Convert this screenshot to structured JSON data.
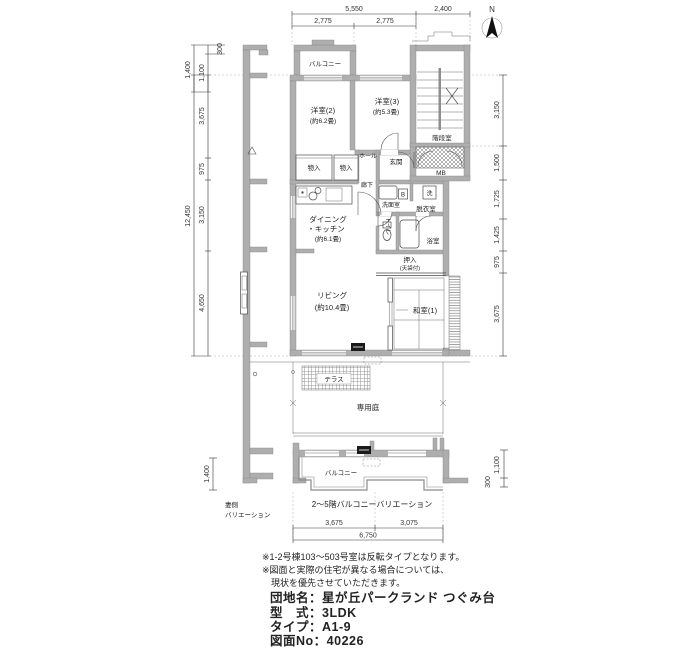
{
  "compass": {
    "north_label": "N"
  },
  "dims": {
    "top": {
      "total": "5,550",
      "left_half": "2,775",
      "right_half": "2,775",
      "stair": "2,400"
    },
    "left": {
      "w300": "300",
      "w1400": "1,400",
      "w1100": "1,100",
      "total": "12,450",
      "r1": "3,675",
      "r2": "975",
      "r3": "3,150",
      "r4": "4,650"
    },
    "right": {
      "r1": "3,150",
      "r2": "1,500",
      "r3": "1,725",
      "r4": "1,425",
      "r5": "975",
      "r6": "3,675"
    },
    "bottom": {
      "left": "3,675",
      "right": "3,075",
      "total": "6,750"
    },
    "bottom_left": {
      "h": "1,400"
    },
    "bottom_right": {
      "w1100": "1,100",
      "w300": "300"
    }
  },
  "rooms": {
    "balcony_top": "バルコニー",
    "bed2": "洋室(2)",
    "bed2_size": "(約6.2畳)",
    "bed3": "洋室(3)",
    "bed3_size": "(約5.3畳)",
    "stairwell": "階段室",
    "mb": "MB",
    "entrance": "玄関",
    "hall": "ホール",
    "closet1": "物入",
    "closet2": "物入",
    "corridor": "廊下",
    "washroom": "洗面室",
    "basin_tag": "B",
    "laundry_tag": "洗",
    "dressing": "脱衣室",
    "toilet": "トイレ",
    "bath": "浴室",
    "dk1": "ダイニング",
    "dk2": "・キッチン",
    "dk_size": "(約6.1畳)",
    "oshiire": "押入",
    "oshiire_note": "(天袋付)",
    "living": "リビング",
    "living_size": "(約10.4畳)",
    "washitsu": "和室(1)",
    "terrace": "テラス",
    "garden": "専用庭",
    "balcony_bottom": "バルコニー"
  },
  "captions": {
    "gable1": "妻側",
    "gable2": "バリエーション",
    "balcony_variation": "2〜5階バルコニーバリエーション"
  },
  "notes": [
    "※1-2号棟103〜503号室は反転タイプとなります。",
    "※図面と実際の住宅が異なる場合については、",
    "現状を優先させていただきます。"
  ],
  "info": {
    "lines": [
      "団地名：星が丘パークランド つぐみ台",
      "型　式：3LDK",
      "タイプ：A1-9",
      "図面No：40226"
    ]
  }
}
